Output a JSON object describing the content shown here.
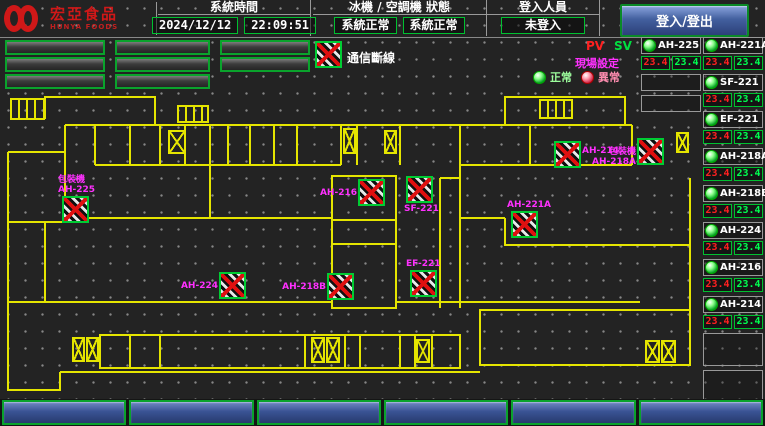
{
  "header": {
    "logo_text": "宏亞食品",
    "logo_sub": "HUNYA FOODS",
    "system_time_label": "系統時間",
    "date": "2024/12/12",
    "time": "22:09:51",
    "status_label": "冰機 / 空調機 狀態",
    "chiller_status": "系統正常",
    "ac_status": "系統正常",
    "login_label": "登入人員",
    "login_status": "未登入",
    "login_button": "登入/登出"
  },
  "floor_buttons": [
    "2BC",
    "4BC",
    "2E",
    "3BC",
    "5BC",
    "3E",
    "3D",
    "1E"
  ],
  "legend": {
    "comm_loss_label": "通信斷線",
    "pv_label": "PV",
    "sv_label": "SV",
    "setting_label": "現場設定",
    "normal_label": "正常",
    "abnormal_label": "異常"
  },
  "colors": {
    "accent_green": "#00c030",
    "wall_yellow": "#e5e500",
    "pv_red": "#ff2020",
    "sv_green": "#00ff50",
    "label_magenta": "#ff30ff",
    "logo_red": "#d01818",
    "button_blue": "#3a5394"
  },
  "left_units": [
    {
      "name": "AH-225",
      "pv": "23.4",
      "sv": "23.4"
    }
  ],
  "right_units": [
    {
      "name": "AH-221A",
      "pv": "23.4",
      "sv": "23.4"
    },
    {
      "name": "SF-221",
      "pv": "23.4",
      "sv": "23.4"
    },
    {
      "name": "EF-221",
      "pv": "23.4",
      "sv": "23.4"
    },
    {
      "name": "AH-218A",
      "pv": "23.4",
      "sv": "23.4"
    },
    {
      "name": "AH-218B",
      "pv": "23.4",
      "sv": "23.4"
    },
    {
      "name": "AH-224",
      "pv": "23.4",
      "sv": "23.4"
    },
    {
      "name": "AH-216",
      "pv": "23.4",
      "sv": "23.4"
    },
    {
      "name": "AH-214",
      "pv": "23.4",
      "sv": "23.4"
    }
  ],
  "floorplan": {
    "markers": [
      {
        "name": "AH-225",
        "equipment": "包裝機",
        "x": 62,
        "y": 106,
        "label_pos": "above"
      },
      {
        "name": "AH-224",
        "x": 219,
        "y": 182,
        "label_pos": "left"
      },
      {
        "name": "AH-216",
        "x": 358,
        "y": 89,
        "label_pos": "left"
      },
      {
        "name": "SF-221",
        "x": 406,
        "y": 86,
        "label_pos": "below"
      },
      {
        "name": "AH-218B",
        "x": 327,
        "y": 183,
        "label_pos": "left"
      },
      {
        "name": "EF-221",
        "x": 410,
        "y": 180,
        "label_pos": "above"
      },
      {
        "name": "AH-221A",
        "x": 511,
        "y": 121,
        "label_pos": "above"
      },
      {
        "name": "AH-214",
        "x": 554,
        "y": 51,
        "label_pos": "right"
      },
      {
        "name": "AH-218A",
        "equipment": "包裝機",
        "x": 637,
        "y": 48,
        "label_pos": "left"
      }
    ],
    "room_labels": [
      {
        "text": "工具室",
        "x": 104,
        "y": 38,
        "vertical": true
      },
      {
        "text": "含浸工場",
        "x": 148,
        "y": 50
      },
      {
        "text": "更衣室",
        "x": 231,
        "y": 36,
        "vertical": true
      },
      {
        "text": "洗手間",
        "x": 255,
        "y": 36,
        "vertical": true
      },
      {
        "text": "準備室",
        "x": 279,
        "y": 36,
        "vertical": true
      },
      {
        "text": "烘焙室",
        "x": 316,
        "y": 36,
        "vertical": true
      },
      {
        "text": "AH-B3",
        "x": 462,
        "y": 44
      },
      {
        "text": "包裝材料室",
        "x": 498,
        "y": 57
      },
      {
        "text": "工務辦公室",
        "x": 548,
        "y": 75
      },
      {
        "text": "材料室",
        "x": 638,
        "y": 75
      },
      {
        "text": "管道間",
        "x": 668,
        "y": 98,
        "vertical": true
      },
      {
        "text": "包裝室",
        "x": 352,
        "y": 125
      },
      {
        "text": "更衣室",
        "x": 352,
        "y": 172
      },
      {
        "text": "倉庫管理室",
        "x": 108,
        "y": 134
      },
      {
        "text": "工場控制室",
        "x": 185,
        "y": 132
      },
      {
        "text": "冰機室",
        "x": 50,
        "y": 158,
        "vertical": true
      },
      {
        "text": "電梯機房",
        "x": 110,
        "y": 217
      },
      {
        "text": "女廁",
        "x": 330,
        "y": 252
      },
      {
        "text": "男廁",
        "x": 380,
        "y": 252
      },
      {
        "text": "更衣室",
        "x": 664,
        "y": 172
      },
      {
        "text": "廁所",
        "x": 664,
        "y": 232
      }
    ],
    "elevators": [
      {
        "x": 168,
        "y": 40,
        "w": 18,
        "h": 24
      },
      {
        "x": 343,
        "y": 38,
        "w": 13,
        "h": 26
      },
      {
        "x": 384,
        "y": 40,
        "w": 13,
        "h": 24
      },
      {
        "x": 676,
        "y": 42,
        "w": 13,
        "h": 21
      },
      {
        "x": 72,
        "y": 247,
        "w": 13,
        "h": 25
      },
      {
        "x": 86,
        "y": 247,
        "w": 13,
        "h": 25
      },
      {
        "x": 311,
        "y": 247,
        "w": 14,
        "h": 26
      },
      {
        "x": 326,
        "y": 247,
        "w": 14,
        "h": 26
      },
      {
        "x": 416,
        "y": 249,
        "w": 14,
        "h": 24
      },
      {
        "x": 645,
        "y": 250,
        "w": 15,
        "h": 23
      },
      {
        "x": 661,
        "y": 250,
        "w": 15,
        "h": 23
      }
    ]
  },
  "bottom_buttons": [
    "空調系統",
    "空調箱系統",
    "參數設定",
    "儀表監視",
    "密碼權限",
    "異常警報"
  ]
}
